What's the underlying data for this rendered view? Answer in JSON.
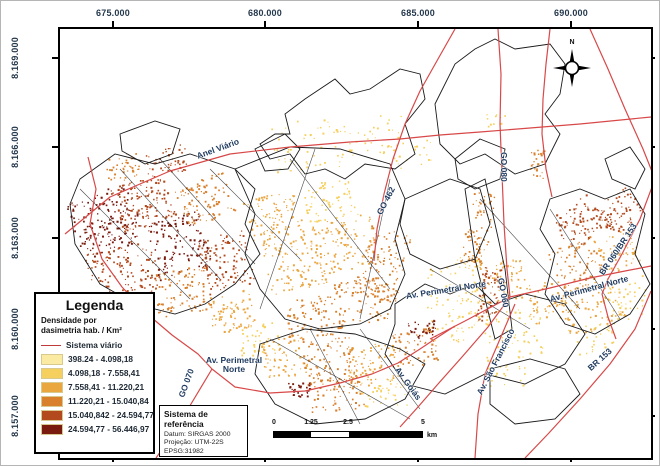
{
  "axes": {
    "x_labels": [
      "675.000",
      "680.000",
      "685.000",
      "690.000"
    ],
    "y_labels": [
      "8.169.000",
      "8.166.000",
      "8.163.000",
      "8.160.000",
      "8.157.000"
    ]
  },
  "compass": {
    "north_label": "N"
  },
  "legend": {
    "title": "Legenda",
    "subtitle_line1": "Densidade por",
    "subtitle_line2": "dasimetria hab. / Km²",
    "road_item": {
      "label": "Sistema viário",
      "color": "#C03A3A"
    },
    "classes": [
      {
        "label": "398.24 - 4.098,18",
        "color": "#FBEBA2"
      },
      {
        "label": "4.098,18 - 7.558,41",
        "color": "#F5D05F"
      },
      {
        "label": "7.558,41 - 11.220,21",
        "color": "#EAA63F"
      },
      {
        "label": "11.220,21 - 15.040,84",
        "color": "#D8802C"
      },
      {
        "label": "15.040,842 - 24.594,77",
        "color": "#B24A1E"
      },
      {
        "label": "24.594,77 - 56.446,97",
        "color": "#7A1B10"
      }
    ]
  },
  "reference_box": {
    "title": "Sistema de referência",
    "datum": "Datum: SIRGAS 2000",
    "projection": "Projeção: UTM-22S",
    "epsg": "EPSG:31982"
  },
  "scale_bar": {
    "labels": [
      "0",
      "1.25",
      "2.5",
      "5"
    ],
    "unit": "km"
  },
  "road_labels": [
    {
      "id": "anel-viario",
      "text": "Anel Viário"
    },
    {
      "id": "go-462",
      "text": "GO 462"
    },
    {
      "id": "go-080",
      "text": "GO 080"
    },
    {
      "id": "av-perimetral-norte-center",
      "text": "Av. Perimetral Norte"
    },
    {
      "id": "go-060",
      "text": "GO 060"
    },
    {
      "id": "av-perimetral-norte-right",
      "text": "Av. Perimetral Norte"
    },
    {
      "id": "av-sao-francisco",
      "text": "Av. São Francisco"
    },
    {
      "id": "br-060-br-153",
      "text": "BR 060/BR 153"
    },
    {
      "id": "br-153",
      "text": "BR 153"
    },
    {
      "id": "go-070",
      "text": "GO 070"
    },
    {
      "id": "av-perimetral-norte-south",
      "text": "Av. Perimetral Norte"
    },
    {
      "id": "av-goias",
      "text": "Av. Goiás"
    }
  ],
  "colors": {
    "road": "#D84848",
    "road_label": "#1E3A5F",
    "axis_text": "#24384C",
    "frame": "#000000",
    "sector_outline": "#1a1a1a"
  }
}
